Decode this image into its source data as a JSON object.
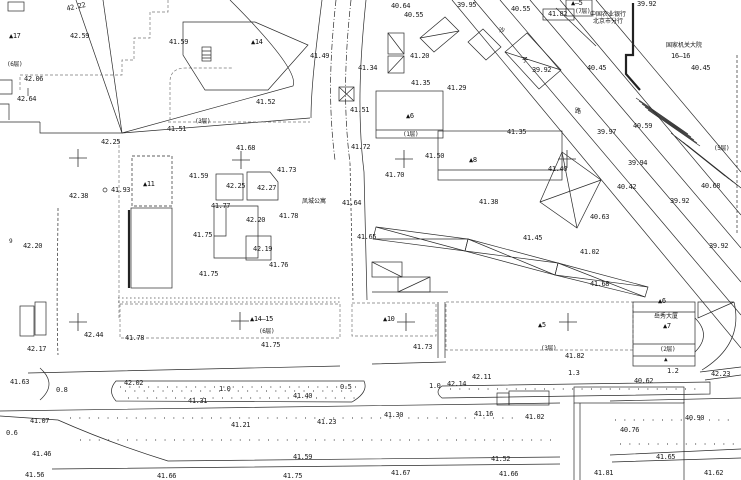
{
  "colors": {
    "ink": "#1d1d1d",
    "paper": "#ffffff"
  },
  "names": {
    "street_chars": [
      "沙",
      "子",
      "路"
    ],
    "apartment": "凤城公寓",
    "tower": "岳秀大厦",
    "bank_line1": "中国农业银行",
    "bank_line2": "北京市分行",
    "gov_line1": "国家机关大院",
    "gov_line2": "16—16"
  },
  "crosses": [
    [
      78,
      158
    ],
    [
      241,
      160
    ],
    [
      404,
      159
    ],
    [
      567,
      159
    ],
    [
      78,
      322
    ],
    [
      240,
      321
    ],
    [
      406,
      322
    ],
    [
      568,
      322
    ]
  ],
  "labels": [
    {
      "t": "42.22",
      "x": 66,
      "y": 6,
      "r": -12
    },
    {
      "t": "40.64",
      "x": 391,
      "y": 3
    },
    {
      "t": "39.95",
      "x": 457,
      "y": 2
    },
    {
      "t": "39.92",
      "x": 637,
      "y": 1
    },
    {
      "t": "40.55",
      "x": 404,
      "y": 12
    },
    {
      "t": "40.55",
      "x": 511,
      "y": 6
    },
    {
      "t": "▲—5",
      "x": 571,
      "y": 0,
      "c": "bld"
    },
    {
      "t": "41.82",
      "x": 548,
      "y": 11
    },
    {
      "t": "(7层)",
      "x": 575,
      "y": 8,
      "c": "floor"
    },
    {
      "t": "中国农业银行",
      "x": 590,
      "y": 12,
      "c": "cjk"
    },
    {
      "t": "北京市分行",
      "x": 593,
      "y": 19,
      "c": "cjk"
    },
    {
      "t": "▲17",
      "x": 9,
      "y": 33,
      "c": "bld"
    },
    {
      "t": "42.59",
      "x": 70,
      "y": 33
    },
    {
      "t": "41.59",
      "x": 169,
      "y": 39
    },
    {
      "t": "▲14",
      "x": 251,
      "y": 39,
      "c": "bld"
    },
    {
      "t": "国家机关大院",
      "x": 666,
      "y": 43,
      "c": "cjk"
    },
    {
      "t": "16—16",
      "x": 671,
      "y": 53
    },
    {
      "t": "沙",
      "x": 499,
      "y": 28,
      "c": "cjk"
    },
    {
      "t": "41.49",
      "x": 310,
      "y": 53
    },
    {
      "t": "41.20",
      "x": 410,
      "y": 53
    },
    {
      "t": "(6层)",
      "x": 7,
      "y": 61,
      "c": "floor"
    },
    {
      "t": "子",
      "x": 522,
      "y": 58,
      "c": "cjk"
    },
    {
      "t": "39.92",
      "x": 532,
      "y": 67
    },
    {
      "t": "40.45",
      "x": 587,
      "y": 65
    },
    {
      "t": "40.45",
      "x": 691,
      "y": 65
    },
    {
      "t": "41.34",
      "x": 358,
      "y": 65
    },
    {
      "t": "42.06",
      "x": 24,
      "y": 76
    },
    {
      "t": "41.35",
      "x": 411,
      "y": 80
    },
    {
      "t": "41.29",
      "x": 447,
      "y": 85
    },
    {
      "t": "42.64",
      "x": 17,
      "y": 96
    },
    {
      "t": "41.52",
      "x": 256,
      "y": 99
    },
    {
      "t": "41.51",
      "x": 350,
      "y": 107
    },
    {
      "t": "路",
      "x": 575,
      "y": 109,
      "c": "cjk"
    },
    {
      "t": "▲6",
      "x": 406,
      "y": 113,
      "c": "bld"
    },
    {
      "t": "(3层)",
      "x": 195,
      "y": 118,
      "c": "floor"
    },
    {
      "t": "40.59",
      "x": 633,
      "y": 123
    },
    {
      "t": "39.97",
      "x": 597,
      "y": 129
    },
    {
      "t": "41.51",
      "x": 167,
      "y": 126
    },
    {
      "t": "41.35",
      "x": 507,
      "y": 129
    },
    {
      "t": "(1层)",
      "x": 403,
      "y": 131,
      "c": "floor"
    },
    {
      "t": "42.25",
      "x": 101,
      "y": 139
    },
    {
      "t": "41.68",
      "x": 236,
      "y": 145
    },
    {
      "t": "41.72",
      "x": 351,
      "y": 144
    },
    {
      "t": "(5层)",
      "x": 714,
      "y": 145,
      "c": "floor"
    },
    {
      "t": "41.50",
      "x": 425,
      "y": 153
    },
    {
      "t": "▲8",
      "x": 469,
      "y": 157,
      "c": "bld"
    },
    {
      "t": "41.40",
      "x": 548,
      "y": 166
    },
    {
      "t": "39.94",
      "x": 628,
      "y": 160
    },
    {
      "t": "41.73",
      "x": 277,
      "y": 167
    },
    {
      "t": "41.59",
      "x": 189,
      "y": 173
    },
    {
      "t": "41.70",
      "x": 385,
      "y": 172
    },
    {
      "t": "42.25",
      "x": 226,
      "y": 183
    },
    {
      "t": "42.27",
      "x": 257,
      "y": 185
    },
    {
      "t": "▲11",
      "x": 143,
      "y": 181,
      "c": "bld"
    },
    {
      "t": "40.42",
      "x": 617,
      "y": 184
    },
    {
      "t": "40.68",
      "x": 701,
      "y": 183
    },
    {
      "t": "41.93",
      "x": 111,
      "y": 187
    },
    {
      "t": "42.38",
      "x": 69,
      "y": 193
    },
    {
      "t": "39.92",
      "x": 670,
      "y": 198
    },
    {
      "t": "凤城公寓",
      "x": 302,
      "y": 199,
      "c": "cjk"
    },
    {
      "t": "41.64",
      "x": 342,
      "y": 200
    },
    {
      "t": "41.38",
      "x": 479,
      "y": 199
    },
    {
      "t": "41.77",
      "x": 211,
      "y": 203
    },
    {
      "t": "40.63",
      "x": 590,
      "y": 214
    },
    {
      "t": "42.20",
      "x": 246,
      "y": 217
    },
    {
      "t": "41.78",
      "x": 279,
      "y": 213
    },
    {
      "t": "41.75",
      "x": 193,
      "y": 232
    },
    {
      "t": "41.65",
      "x": 357,
      "y": 234
    },
    {
      "t": "41.45",
      "x": 523,
      "y": 235
    },
    {
      "t": "9",
      "x": 9,
      "y": 238,
      "c": "sym"
    },
    {
      "t": "42.20",
      "x": 23,
      "y": 243
    },
    {
      "t": "39.92",
      "x": 709,
      "y": 243
    },
    {
      "t": "42.19",
      "x": 253,
      "y": 246
    },
    {
      "t": "41.02",
      "x": 580,
      "y": 249
    },
    {
      "t": "41.76",
      "x": 269,
      "y": 262
    },
    {
      "t": "41.75",
      "x": 199,
      "y": 271
    },
    {
      "t": "41.68",
      "x": 590,
      "y": 281
    },
    {
      "t": "▲6",
      "x": 658,
      "y": 298,
      "c": "bld"
    },
    {
      "t": "▲14—15",
      "x": 250,
      "y": 316,
      "c": "bld"
    },
    {
      "t": "▲10",
      "x": 383,
      "y": 316,
      "c": "bld"
    },
    {
      "t": "岳秀大厦",
      "x": 654,
      "y": 314,
      "c": "cjk"
    },
    {
      "t": "▲7",
      "x": 663,
      "y": 323,
      "c": "bld"
    },
    {
      "t": "▲5",
      "x": 538,
      "y": 322,
      "c": "bld"
    },
    {
      "t": "(6层)",
      "x": 259,
      "y": 328,
      "c": "floor"
    },
    {
      "t": "42.44",
      "x": 84,
      "y": 332
    },
    {
      "t": "41.78",
      "x": 125,
      "y": 335
    },
    {
      "t": "41.75",
      "x": 261,
      "y": 342
    },
    {
      "t": "41.73",
      "x": 413,
      "y": 344
    },
    {
      "t": "(3层)",
      "x": 541,
      "y": 345,
      "c": "floor"
    },
    {
      "t": "42.17",
      "x": 27,
      "y": 346
    },
    {
      "t": "(2层)",
      "x": 660,
      "y": 346,
      "c": "floor"
    },
    {
      "t": "41.82",
      "x": 565,
      "y": 353
    },
    {
      "t": "▲",
      "x": 664,
      "y": 356,
      "c": "sym"
    },
    {
      "t": "41.63",
      "x": 10,
      "y": 379
    },
    {
      "t": "42.02",
      "x": 124,
      "y": 380
    },
    {
      "t": "0.8",
      "x": 56,
      "y": 387,
      "c": "w"
    },
    {
      "t": "1.0",
      "x": 219,
      "y": 386,
      "c": "w"
    },
    {
      "t": "0.5",
      "x": 340,
      "y": 384,
      "c": "w"
    },
    {
      "t": "1.0",
      "x": 429,
      "y": 383,
      "c": "w"
    },
    {
      "t": "42.14",
      "x": 447,
      "y": 381
    },
    {
      "t": "42.11",
      "x": 472,
      "y": 374
    },
    {
      "t": "1.3",
      "x": 568,
      "y": 370,
      "c": "w"
    },
    {
      "t": "1.2",
      "x": 667,
      "y": 368,
      "c": "w"
    },
    {
      "t": "42.23",
      "x": 711,
      "y": 371
    },
    {
      "t": "40.62",
      "x": 634,
      "y": 378
    },
    {
      "t": "41.31",
      "x": 188,
      "y": 398
    },
    {
      "t": "41.40",
      "x": 293,
      "y": 393
    },
    {
      "t": "0.6",
      "x": 6,
      "y": 430,
      "c": "w"
    },
    {
      "t": "41.07",
      "x": 30,
      "y": 418
    },
    {
      "t": "41.21",
      "x": 231,
      "y": 422
    },
    {
      "t": "41.23",
      "x": 317,
      "y": 419
    },
    {
      "t": "41.30",
      "x": 384,
      "y": 412
    },
    {
      "t": "41.16",
      "x": 474,
      "y": 411
    },
    {
      "t": "41.02",
      "x": 525,
      "y": 414
    },
    {
      "t": "40.90",
      "x": 685,
      "y": 415
    },
    {
      "t": "40.76",
      "x": 620,
      "y": 427
    },
    {
      "t": "41.46",
      "x": 32,
      "y": 451
    },
    {
      "t": "41.59",
      "x": 293,
      "y": 454
    },
    {
      "t": "41.52",
      "x": 491,
      "y": 456
    },
    {
      "t": "41.65",
      "x": 656,
      "y": 454
    },
    {
      "t": "41.56",
      "x": 25,
      "y": 472
    },
    {
      "t": "41.66",
      "x": 157,
      "y": 473
    },
    {
      "t": "41.75",
      "x": 283,
      "y": 473
    },
    {
      "t": "41.67",
      "x": 391,
      "y": 470
    },
    {
      "t": "41.66",
      "x": 499,
      "y": 471
    },
    {
      "t": "41.81",
      "x": 594,
      "y": 470
    },
    {
      "t": "41.62",
      "x": 704,
      "y": 470
    }
  ]
}
